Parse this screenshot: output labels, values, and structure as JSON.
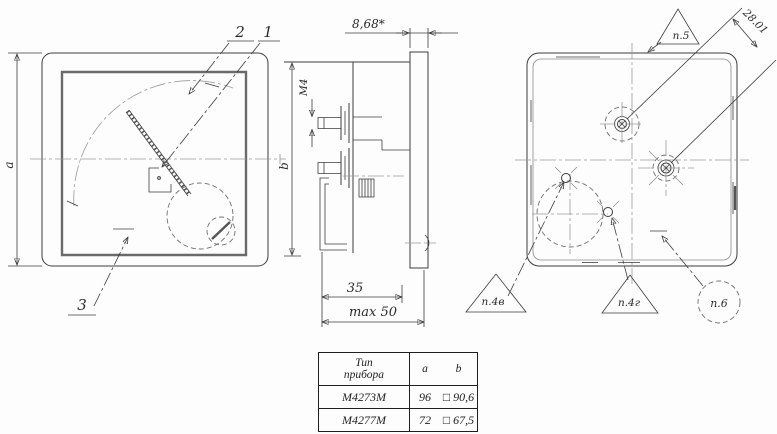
{
  "front_view": {
    "label_2": "2",
    "label_1": "1",
    "label_3": "3",
    "dim_a": "a"
  },
  "side_view": {
    "dim_depth": "8,68*",
    "thread_label": "M4",
    "dim_b": "b",
    "dim_35": "35",
    "dim_max50": "max 50"
  },
  "rear_view": {
    "flag_top": "п.5",
    "dim_diagonal": "28.01",
    "flag_left": "п.4в",
    "flag_middle": "п.4г",
    "flag_right": "п.6"
  },
  "table": {
    "header_type_line1": "Тип",
    "header_type_line2": "прибора",
    "header_a": "a",
    "header_b": "b",
    "rows": [
      {
        "type": "М4273М",
        "a": "96",
        "b": "□ 90,6"
      },
      {
        "type": "М4277М",
        "a": "72",
        "b": "□ 67,5"
      }
    ]
  },
  "colors": {
    "line": "#3d3d3d",
    "centerline": "#9a9a9a",
    "background": "#fdfdfd"
  }
}
